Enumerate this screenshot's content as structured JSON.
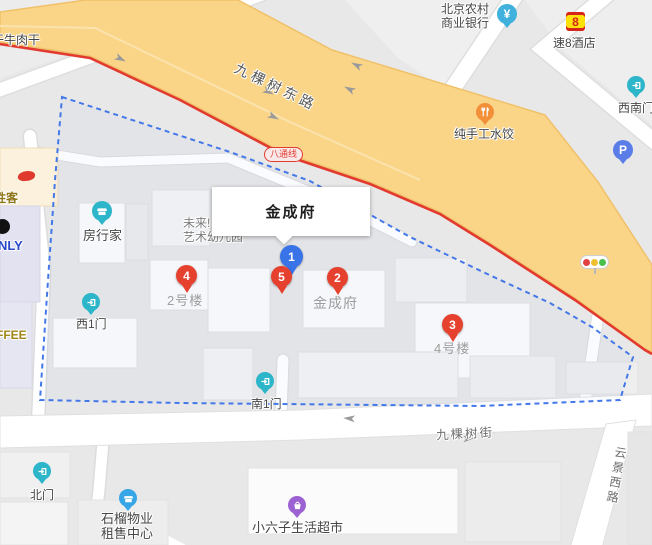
{
  "complex": {
    "name": "金成府"
  },
  "subway": {
    "badge": "八通线"
  },
  "roads": {
    "east_road": "九棵树东路",
    "street": "九棵树街",
    "west_road": "云景西路"
  },
  "markers": [
    {
      "num": "1",
      "color": "blue"
    },
    {
      "num": "2",
      "color": "red"
    },
    {
      "num": "3",
      "color": "red"
    },
    {
      "num": "4",
      "color": "red"
    },
    {
      "num": "5",
      "color": "red"
    }
  ],
  "building_labels": {
    "b2": "2号楼",
    "jinchengfu": "金成府",
    "b4": "4号楼"
  },
  "pois": {
    "beef": {
      "label": "干牛肉干"
    },
    "bank": {
      "line1": "北京农村",
      "line2": "商业银行",
      "currency": "¥"
    },
    "hotel": {
      "logo": "8",
      "label": "速8酒店"
    },
    "gate_sw": {
      "label": "西南门"
    },
    "parking": {
      "label": "P"
    },
    "dumpling": {
      "label": "纯手工水饺"
    },
    "agency": {
      "label": "房行家"
    },
    "kindergarten": {
      "line1": "未来!",
      "line2": "艺术幼儿园"
    },
    "gate_w": {
      "label": "西1门"
    },
    "gate_s": {
      "label": "南1门"
    },
    "gate_n": {
      "label": "北门"
    },
    "property": {
      "line1": "石榴物业",
      "line2": "租售中心"
    },
    "market": {
      "label": "小六子生活超市"
    },
    "pizza": {
      "label": "胜客"
    },
    "only": {
      "label": "NLY"
    },
    "coffee": {
      "label": "FFEE"
    }
  },
  "colors": {
    "main_road_fill": "#fad588",
    "main_road_border": "#f0c169",
    "subway_line": "#e23a2e",
    "boundary": "#4478e8",
    "marker_red": "#e6402f",
    "marker_blue": "#3873e8",
    "gate_icon": "#2db5c9",
    "parking_icon": "#5b7de8",
    "market_icon": "#9c62d2",
    "dumpling_icon": "#f2903a",
    "bank_icon": "#3fb1dc",
    "hotel_logo_bg": "#ffe10a"
  }
}
